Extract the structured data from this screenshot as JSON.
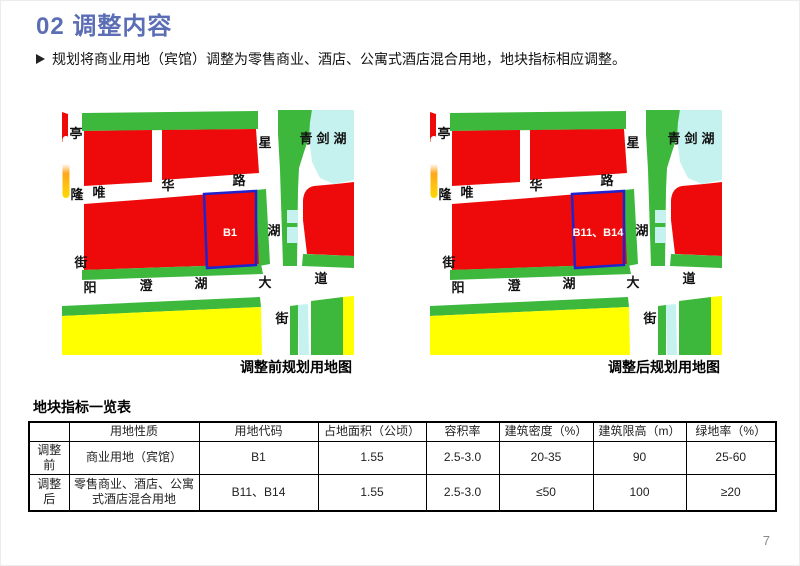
{
  "header": {
    "title": "02 调整内容"
  },
  "bullet": {
    "text": "规划将商业用地（宾馆）调整为零售商业、酒店、公寓式酒店混合用地，地块指标相应调整。"
  },
  "maps": {
    "labels": {
      "ting": "亭",
      "long_": "隆",
      "jie_left": "街",
      "wei": "唯",
      "hua": "华",
      "lu": "路",
      "xing": "星",
      "hu_mid": "湖",
      "jie_bottom": "街",
      "lake": "青剑湖",
      "yang": "阳",
      "cheng": "澄",
      "hu_bottom": "湖",
      "da": "大",
      "dao": "道"
    },
    "before": {
      "parcel_label": "B1",
      "caption": "调整前规划用地图"
    },
    "after": {
      "parcel_label": "B11、B14",
      "caption": "调整后规划用地图"
    }
  },
  "table": {
    "title": "地块指标一览表",
    "headers": [
      "",
      "用地性质",
      "用地代码",
      "占地面积（公顷）",
      "容积率",
      "建筑密度（%）",
      "建筑限高（m）",
      "绿地率（%）"
    ],
    "rows": [
      {
        "label": "调整前",
        "cells": [
          "商业用地（宾馆）",
          "B1",
          "1.55",
          "2.5-3.0",
          "20-35",
          "90",
          "25-60"
        ]
      },
      {
        "label": "调整后",
        "cells": [
          "零售商业、酒店、公寓式酒店混合用地",
          "B11、B14",
          "1.55",
          "2.5-3.0",
          "≤50",
          "100",
          "≥20"
        ]
      }
    ]
  },
  "footer": {
    "page_number": "7"
  },
  "colors": {
    "title_blue": "#5B6EB5",
    "parcel_red": "#EE0A0A",
    "map_green": "#3DB83D",
    "lake_cyan": "#C5F2EF",
    "map_yellow": "#FFFF00",
    "orange": "#FFB300",
    "parcel_outline_blue": "#2222CC"
  }
}
